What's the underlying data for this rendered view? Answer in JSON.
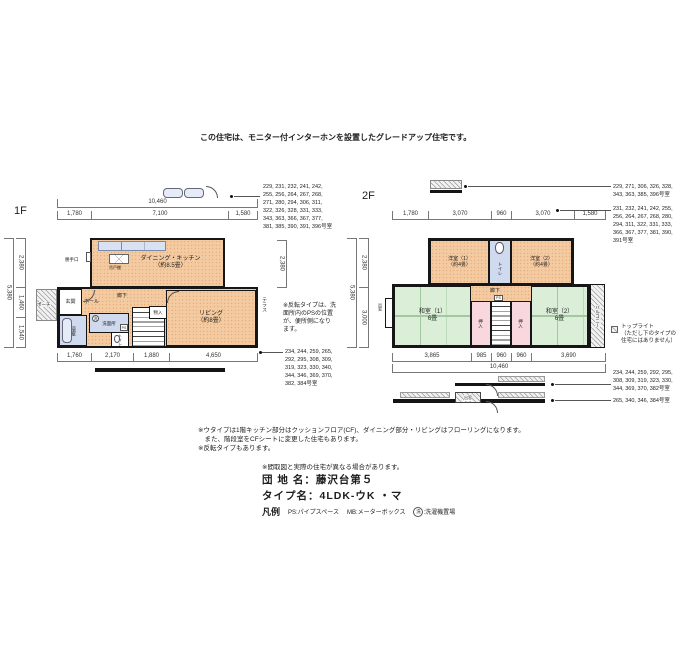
{
  "header": {
    "note": "この住宅は、モニター付インターホンを設置したグレードアップ住宅です。"
  },
  "floor1": {
    "label": "1F",
    "dims": {
      "top_total": "10,460",
      "top": [
        "1,780",
        "7,100",
        "1,580"
      ],
      "left_total": "5,380",
      "left": [
        "2,380",
        "1,460",
        "1,540"
      ],
      "right": "2,380",
      "bottom": [
        "1,760",
        "2,170",
        "1,880",
        "4,650"
      ]
    },
    "rooms": {
      "dk": "ダイニング・キッチン\n（約8.5畳）",
      "katteguchi": "勝手口",
      "tsuridana": "吊戸棚",
      "genkan": "玄関",
      "hall": "ホール",
      "roka": "廊下",
      "living": "リビング\n（約8畳）",
      "senmenjo": "洗面所",
      "yokushitsu": "浴室",
      "toilet": "トイレ",
      "monoire": "物入",
      "porch": "ポーチ",
      "terrace": "テラス",
      "ps": "PS",
      "laundry": "洗"
    },
    "note": "※反転タイプは、洗\n面所内のPSの位置\nが、便所側になり\nます。",
    "room_list_top": "229, 231, 232, 241, 242,\n255, 256, 264, 267, 268,\n271, 280, 294, 306, 311,\n322, 326, 328, 331, 333,\n343, 363, 366, 367, 377,\n381, 385, 390, 391, 396号室",
    "room_list_bottom": "234, 244, 259, 265,\n292, 295, 308, 309,\n319, 323, 330, 340,\n344, 346, 369, 370,\n382, 384号室"
  },
  "floor2": {
    "label": "2F",
    "dims": {
      "top": [
        "1,780",
        "3,070",
        "960",
        "3,070",
        "1,580"
      ],
      "left_total": "5,380",
      "left": [
        "2,380",
        "3,000"
      ],
      "bottom": [
        "3,865",
        "985",
        "960",
        "960",
        "3,690"
      ],
      "bottom_total": "10,460"
    },
    "rooms": {
      "yoshitsu1": "洋室（1）\n（約4畳）",
      "yoshitsu2": "洋室（2）\n（約4畳）",
      "toilet": "トイレ",
      "washitsu1": "和室（1）\n6畳",
      "washitsu2": "和室（2）\n6畳",
      "roka": "廊下",
      "ps": "PS",
      "oshiire_left": "押入",
      "oshiire_right": "押入",
      "balcony": "バルコニー",
      "demado": "出窓"
    },
    "toplight_note": "トップライト\n（ただし下のタイプの\n住宅にはありません）",
    "demado_section": "出窓",
    "room_list_a": "229, 271, 306, 326, 328,\n343, 363, 385, 396号室",
    "room_list_b": "231, 232, 241, 242, 255,\n256, 264, 267, 268, 280,\n294, 311, 322, 331, 333,\n366, 367, 377, 381, 390,\n391号室",
    "room_list_c": "234, 244, 259, 292, 295,\n308, 309, 319, 323, 330,\n344, 369, 370, 382号室",
    "room_list_d": "265, 340, 346, 384号室"
  },
  "footer": {
    "note1": "※ウタイプは1階キッチン部分はクッションフロア(CF)、ダイニング部分・リビングはフローリングになります。\n　また、階段室をCFシートに変更した住宅もあります。\n※反転タイプもあります。",
    "note2": "※間取図と実際の住宅が異なる場合があります。",
    "danchi": "団 地 名：藤沢台第５",
    "type_name": "タイプ名：4LDK-ウK ・マ",
    "legend_title": "凡例",
    "legend_ps": "PS:パイプスペース",
    "legend_mb": "MB:メーターボックス",
    "legend_laundry_symbol": "洗",
    "legend_laundry": ":洗濯機置場"
  }
}
